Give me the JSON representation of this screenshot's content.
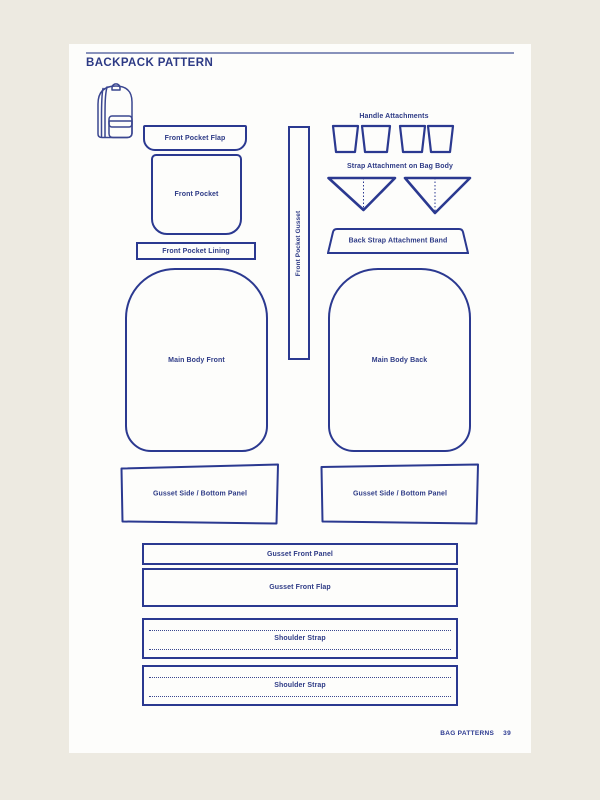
{
  "header": {
    "title": "BACKPACK PATTERN"
  },
  "footer": {
    "label": "BAG PATTERNS",
    "page_number": "39"
  },
  "sections": {
    "handle_attachments": "Handle Attachments",
    "strap_attachment": "Strap Attachment on Bag Body"
  },
  "pieces": {
    "front_pocket_flap": "Front Pocket Flap",
    "front_pocket": "Front Pocket",
    "front_pocket_lining": "Front Pocket Lining",
    "front_pocket_gusset": "Front Pocket Gusset",
    "back_strap_attachment_band": "Back Strap Attachment Band",
    "main_body_front": "Main Body Front",
    "main_body_back": "Main Body Back",
    "gusset_side_bottom_panel": "Gusset Side / Bottom Panel",
    "gusset_front_panel": "Gusset Front Panel",
    "gusset_front_flap": "Gusset Front Flap",
    "shoulder_strap": "Shoulder Strap"
  },
  "colors": {
    "outline_navy": "#2b3990",
    "text_navy": "#2d3a85",
    "page_background": "#fdfdfb",
    "surround_background": "#edeae1"
  }
}
